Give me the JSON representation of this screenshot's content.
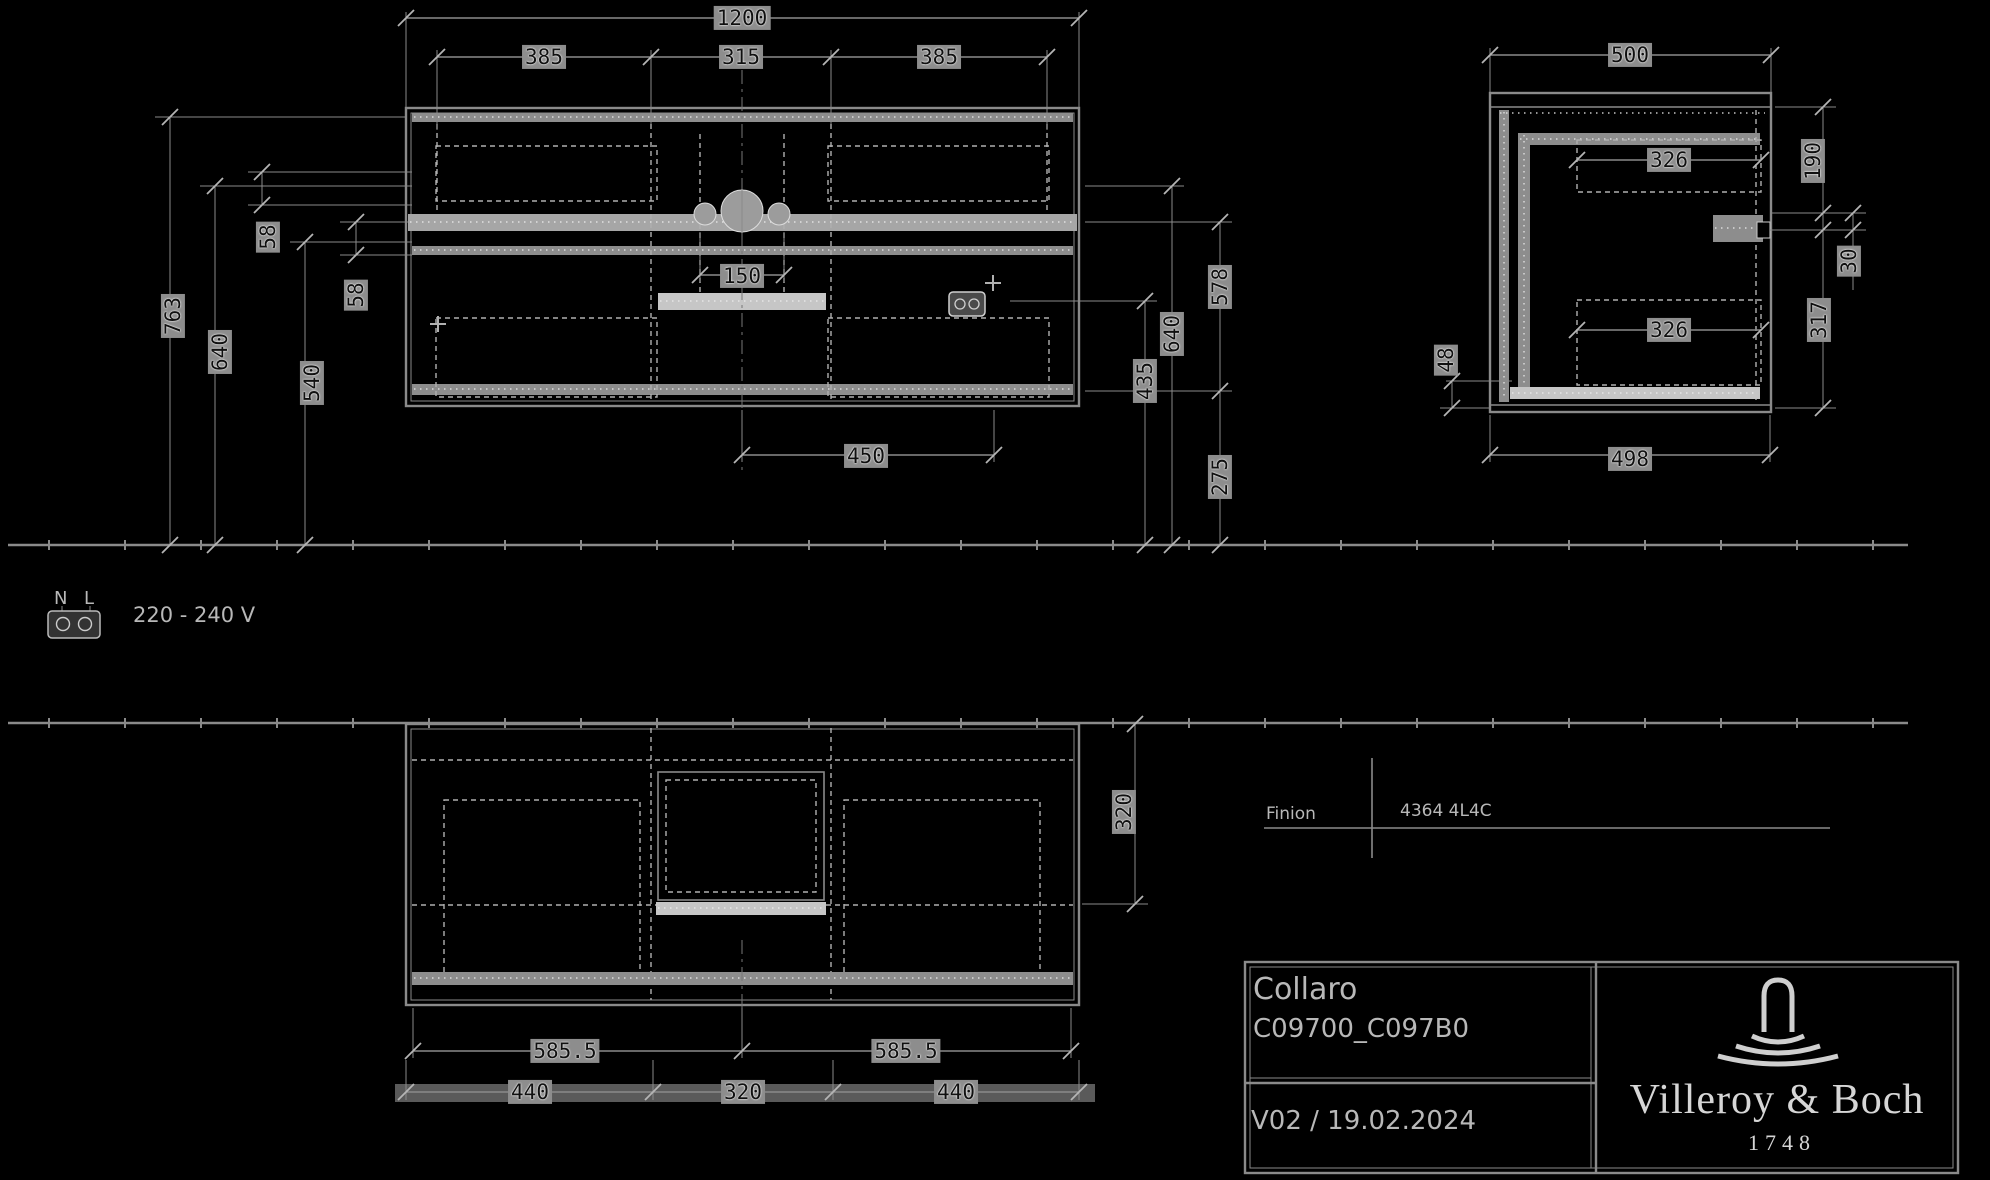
{
  "drawing": {
    "front_view": {
      "dims": {
        "total_width": "1200",
        "widths": [
          "385",
          "315",
          "385"
        ],
        "left_heights": [
          "763",
          "640",
          "540"
        ],
        "gaps": [
          "58",
          "58"
        ],
        "center": "150",
        "right_heights": [
          "578",
          "640",
          "435",
          "275"
        ],
        "bottom": "450"
      }
    },
    "side_view": {
      "dims": {
        "top": "500",
        "upper_inner": "326",
        "right_top": "190",
        "right_small": "30",
        "right_lower": "317",
        "lower_inner": "326",
        "left_small": "48",
        "bottom": "498"
      }
    },
    "plan_view": {
      "dims": {
        "right": "320",
        "row1": [
          "585.5",
          "585.5"
        ],
        "row2": [
          "440",
          "320",
          "440"
        ]
      }
    },
    "electrical": {
      "n": "N",
      "l": "L",
      "voltage": "220 - 240 V"
    },
    "reference": {
      "label": "Finion",
      "code": "4364 4L4C"
    },
    "title_block": {
      "series": "Collaro",
      "article": "C09700_C097B0",
      "version": "V02 / 19.02.2024",
      "brand": "Villeroy & Boch",
      "brand_year": "1748"
    }
  },
  "colors": {
    "background": "#000000",
    "line": "#8a8a8a",
    "lineLight": "#b0b0b0",
    "band": "#8d8d8d",
    "bandLight": "#c6c6c6",
    "dash": "#ececec",
    "patch": "#8d8d8d",
    "ink": "#b8b8b8",
    "inkDark": "#101010",
    "brandInk": "#d6d6d6"
  }
}
